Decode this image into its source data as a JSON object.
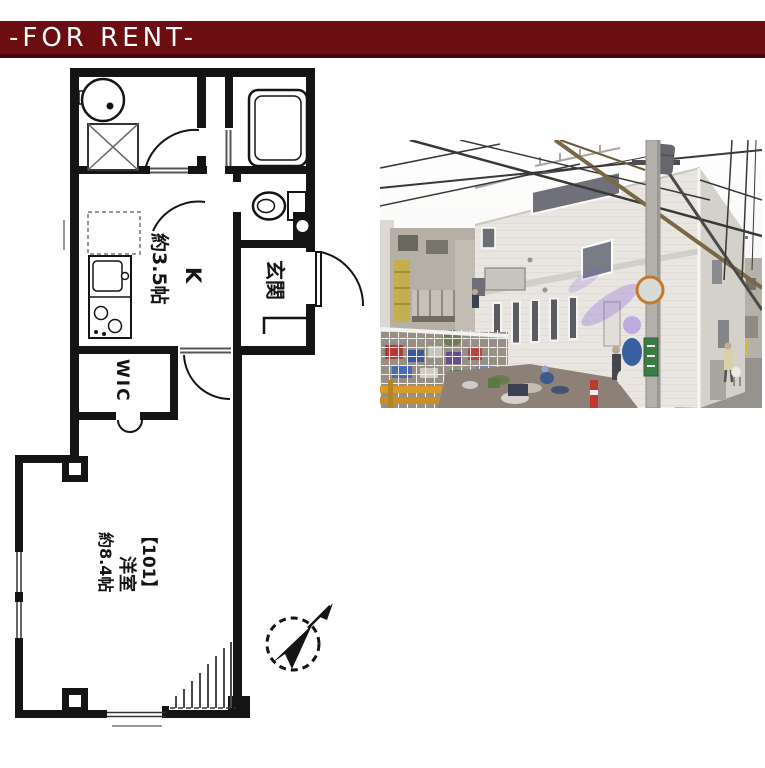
{
  "banner": {
    "label": "-FOR RENT-",
    "bg_color": "#6b0d11",
    "shadow_color": "#45070a",
    "text_color": "#ffffff"
  },
  "floor_plan": {
    "ink_color": "#141414",
    "kitchen_abbr": "K",
    "kitchen_size": "約3.5帖",
    "entrance_label": "玄関",
    "closet_label": "WIC",
    "room_number": "【101】",
    "room_type": "洋室",
    "room_size": "約8.4帖"
  }
}
